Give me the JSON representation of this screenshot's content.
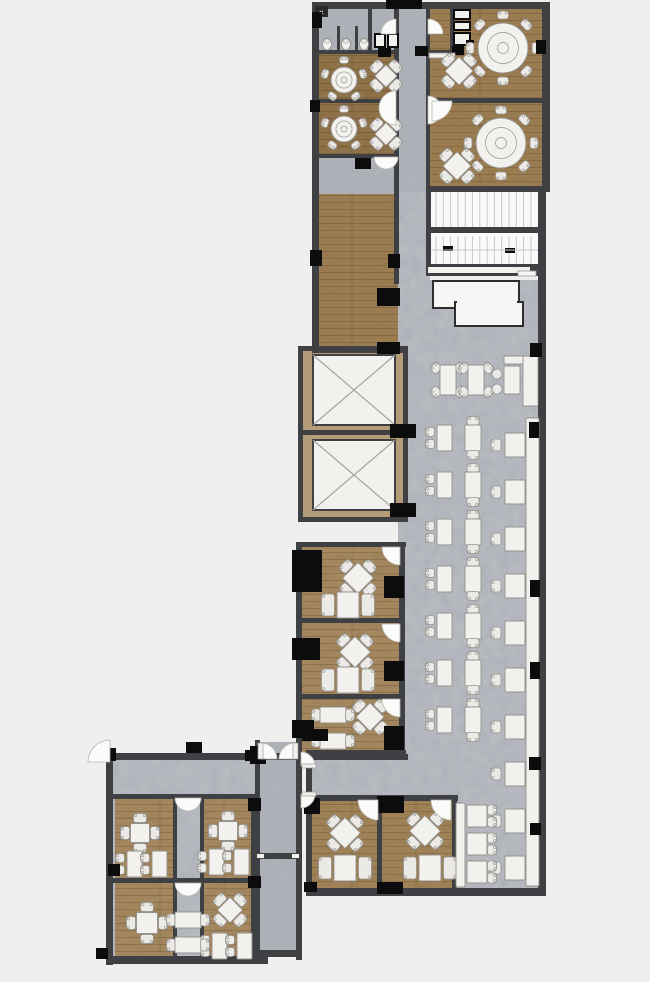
{
  "title": "Restaurant floor plan",
  "palette": {
    "background": "#f0efed",
    "wall": "#3f4043",
    "fixture": "#0c0c0d",
    "wood_dark": "#8e7045",
    "wood": "#9b7b50",
    "wood_mid": "#a5885e",
    "wood_warm": "#a08257",
    "tan": "#b59c78",
    "concrete": "#b7bac0",
    "concrete_dark": "#adb1b7",
    "furniture": "#f2f1ee",
    "chair": "#eceae6",
    "furniture_stroke": "#94928e",
    "stair_fill": "#fafaf9",
    "stair_tread": "#c9c9cb",
    "door_arc": "#fbfbf9",
    "door_arc_stroke": "#b9b7b2",
    "counter_stroke": "#2e2e30",
    "plank_line": "rgba(62,40,20,0.28)"
  },
  "plan": {
    "areas": [
      {
        "id": "restroom",
        "label": "Restroom",
        "floor": "stone"
      },
      {
        "id": "entry-corridor",
        "label": "Entry corridor",
        "floor": "stone"
      },
      {
        "id": "private-dining-a",
        "label": "Private dining room A",
        "floor": "wood"
      },
      {
        "id": "private-dining-b",
        "label": "Private dining room B",
        "floor": "wood"
      },
      {
        "id": "vestibule",
        "label": "Vestibule",
        "floor": "stone"
      },
      {
        "id": "banquet-room-1",
        "label": "Banquet room 1",
        "floor": "wood"
      },
      {
        "id": "banquet-room-2",
        "label": "Banquet room 2",
        "floor": "wood"
      },
      {
        "id": "service-pantry",
        "label": "Service pantry",
        "floor": "wood"
      },
      {
        "id": "function-room",
        "label": "Function room",
        "floor": "wood"
      },
      {
        "id": "staircase",
        "label": "Staircase",
        "floor": "stone"
      },
      {
        "id": "service-counter",
        "label": "Service counter",
        "floor": "stone"
      },
      {
        "id": "elevator-bank",
        "label": "Elevator bank",
        "floor": "stone"
      },
      {
        "id": "main-dining-hall",
        "label": "Main dining hall",
        "floor": "stone"
      },
      {
        "id": "booth-seating",
        "label": "Booth seating along east wall",
        "floor": "stone"
      },
      {
        "id": "private-room-1",
        "label": "Private room 1",
        "floor": "wood"
      },
      {
        "id": "private-room-2",
        "label": "Private room 2",
        "floor": "wood"
      },
      {
        "id": "private-room-3",
        "label": "Private room 3",
        "floor": "wood"
      },
      {
        "id": "entrance-lobby",
        "label": "Entrance lobby",
        "floor": "stone"
      },
      {
        "id": "lobby-corridor",
        "label": "Lobby corridor",
        "floor": "stone"
      },
      {
        "id": "private-room-4",
        "label": "Private room 4",
        "floor": "wood"
      },
      {
        "id": "private-room-5",
        "label": "Private room 5",
        "floor": "wood"
      },
      {
        "id": "private-room-6",
        "label": "Private room 6",
        "floor": "wood"
      },
      {
        "id": "private-room-7",
        "label": "Private room 7",
        "floor": "wood"
      },
      {
        "id": "side-passage",
        "label": "Side passage",
        "floor": "stone"
      },
      {
        "id": "private-room-8",
        "label": "Private room 8",
        "floor": "wood"
      },
      {
        "id": "private-room-9",
        "label": "Private room 9",
        "floor": "wood"
      },
      {
        "id": "lounge-dining",
        "label": "Lounge dining",
        "floor": "stone"
      }
    ],
    "furniture_counts": {
      "large_round_tables": 2,
      "small_round_tables": 2,
      "x_tables": 10,
      "cross_tables": 3,
      "sofa_table_sets": 5,
      "two_seat_tables": 26,
      "booth_tables": 14,
      "corner_chair_tables": 2,
      "elevators": 2,
      "staircases": 1,
      "toilets": 3,
      "urinal_stalls": 2
    }
  }
}
